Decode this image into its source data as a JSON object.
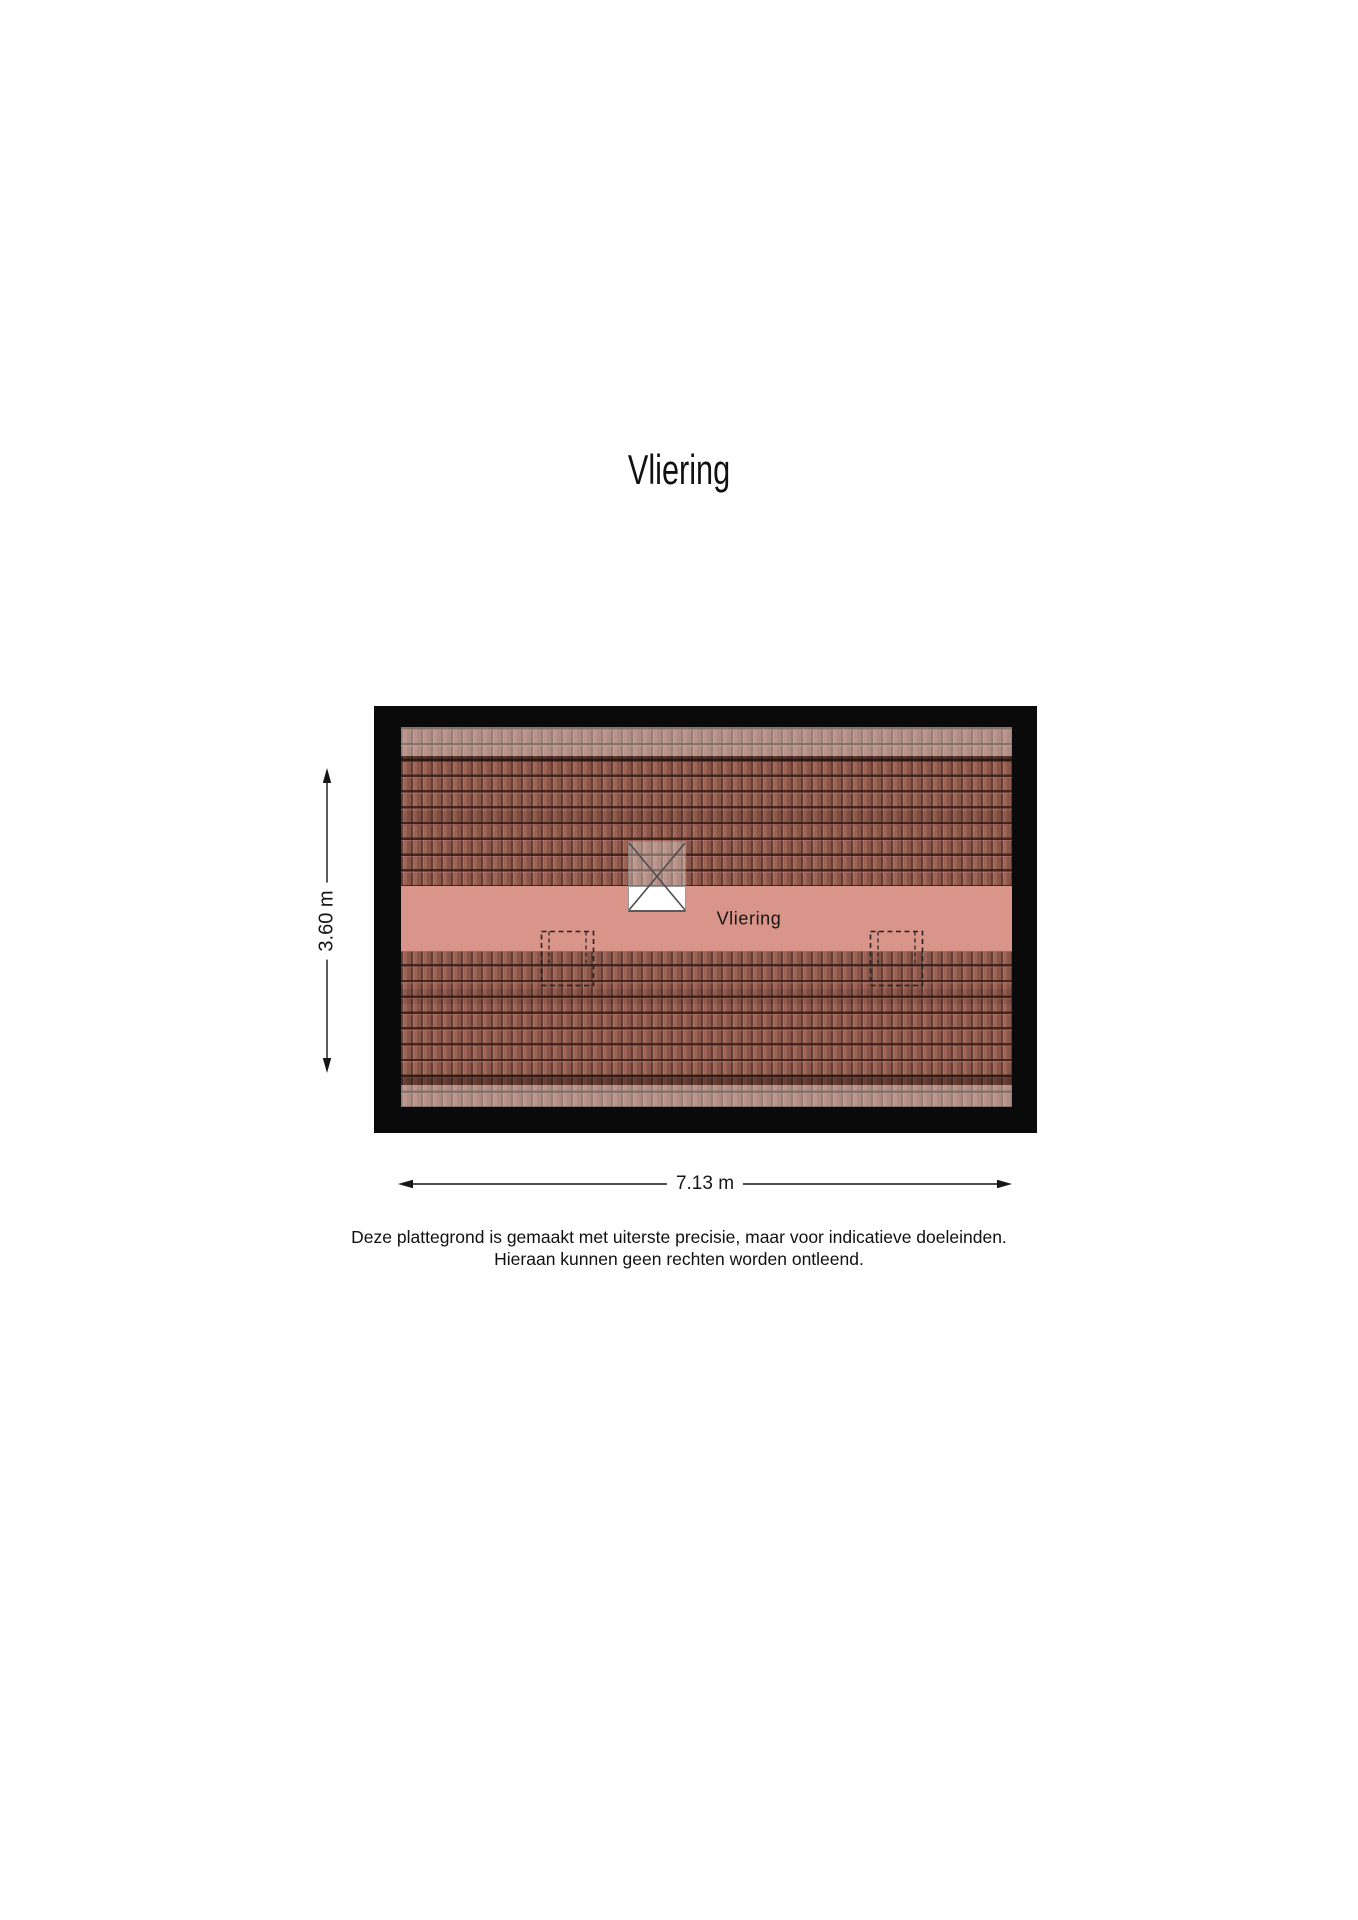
{
  "page": {
    "title": "Vliering"
  },
  "colors": {
    "wall": "#0a0a0a",
    "tile": "#9d6355",
    "floor": "#d9958a",
    "ink": "#111111"
  },
  "floorplan": {
    "room_label": "Vliering",
    "dimensions": {
      "height_label": "3.60 m",
      "width_label": "7.13 m"
    }
  },
  "disclaimer": {
    "line1": "Deze plattegrond is gemaakt met uiterste precisie, maar voor indicatieve doeleinden.",
    "line2": "Hieraan kunnen geen rechten worden ontleend."
  }
}
